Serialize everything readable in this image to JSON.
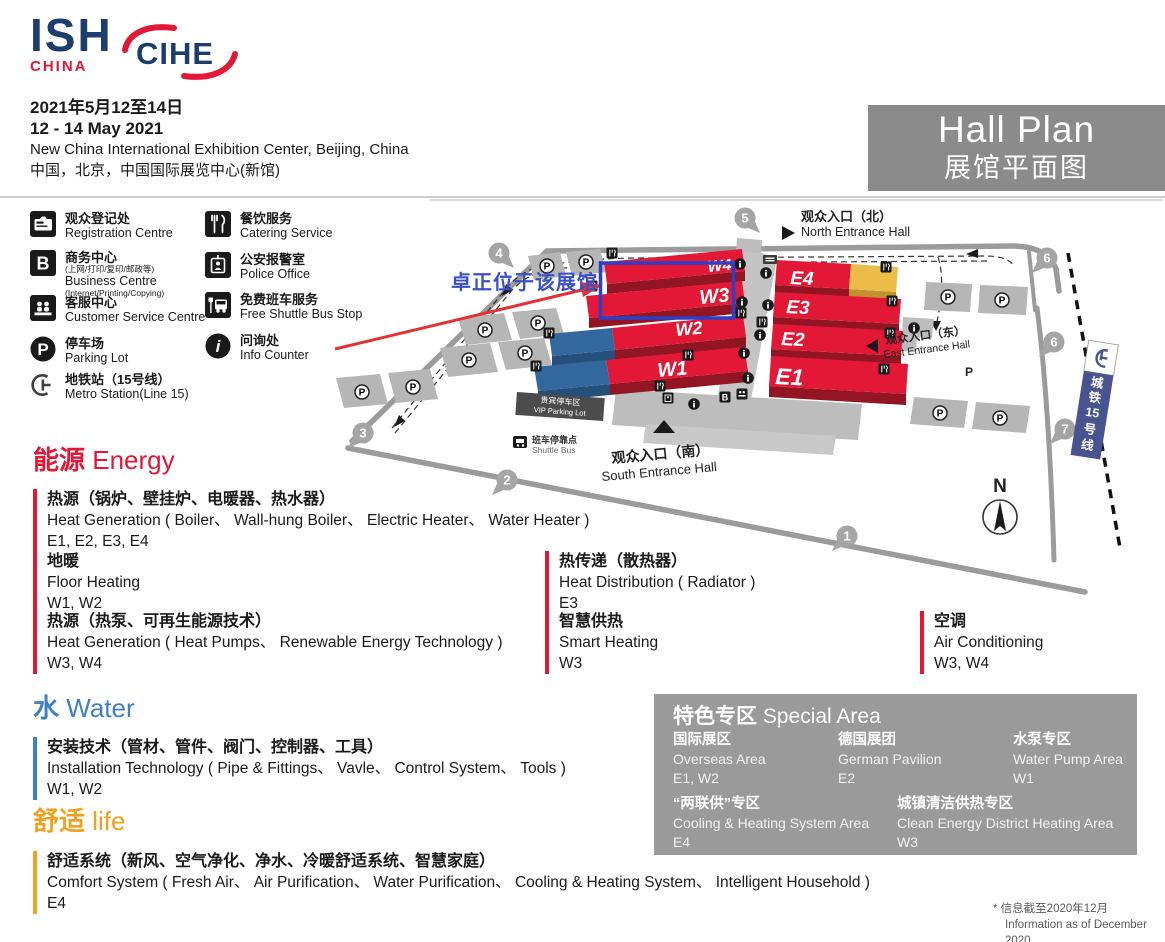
{
  "header": {
    "ish": "ISH",
    "ish_sub": "CHINA",
    "cihe": "CIHE",
    "date_cn": "2021年5月12至14日",
    "date_en": "12 - 14 May 2021",
    "venue_en": "New China International Exhibition Center, Beijing, China",
    "venue_cn": "中国，北京，中国国际展览中心(新馆)",
    "title_en": "Hall Plan",
    "title_cn": "展馆平面图"
  },
  "legend": {
    "items": [
      {
        "icon": "registration-icon",
        "cn": "观众登记处",
        "en": "Registration Centre"
      },
      {
        "icon": "business-icon",
        "glyph": "B",
        "cn": "商务中心",
        "cn_sub": "(上网/打印/复印/邮政等)",
        "en": "Business Centre",
        "en_sub": "(Internet/Printing/Copying)"
      },
      {
        "icon": "customer-service-icon",
        "cn": "客服中心",
        "en": "Customer Service Centre"
      },
      {
        "icon": "parking-icon",
        "glyph": "P",
        "cn": "停车场",
        "en": "Parking Lot"
      },
      {
        "icon": "metro-icon",
        "cn": "地铁站（15号线）",
        "en": "Metro Station(Line 15)"
      },
      {
        "icon": "catering-icon",
        "cn": "餐饮服务",
        "en": "Catering Service"
      },
      {
        "icon": "police-icon",
        "cn": "公安报警室",
        "en": "Police Office"
      },
      {
        "icon": "shuttle-bus-icon",
        "cn": "免费班车服务",
        "en": "Free Shuttle Bus Stop"
      },
      {
        "icon": "info-icon",
        "glyph": "i",
        "cn": "问询处",
        "en": "Info Counter"
      }
    ]
  },
  "map": {
    "halls": {
      "w1": "W1",
      "w2": "W2",
      "w3": "W3",
      "w4": "W4",
      "e1": "E1",
      "e2": "E2",
      "e3": "E3",
      "e4": "E4"
    },
    "entrances": {
      "north_cn": "观众入口（北）",
      "north_en": "North Entrance Hall",
      "south_cn": "观众入口（南）",
      "south_en": "South Entrance Hall",
      "east_cn": "观众入口（东）",
      "east_en": "East Entrance Hall"
    },
    "gates": [
      "1",
      "2",
      "3",
      "4",
      "5",
      "6",
      "6",
      "7"
    ],
    "vip_cn": "贵宾停车区",
    "vip_en": "VIP Parking Lot",
    "shuttle_cn": "班车停靠点",
    "shuttle_en": "Shuttle Bus",
    "metro_chars": [
      "城",
      "铁",
      "15",
      "号",
      "线"
    ],
    "compass_n": "N",
    "p": "P",
    "b": "B",
    "annotation": "卓正位于该展馆"
  },
  "sections": {
    "energy": {
      "title_cn": "能源",
      "title_en": "Energy",
      "color": "#e31837",
      "items": [
        {
          "cn": "热源（锅炉、壁挂炉、电暖器、热水器）",
          "en": "Heat Generation ( Boiler、 Wall-hung Boiler、 Electric Heater、 Water Heater )",
          "halls": "E1, E2, E3, E4"
        },
        {
          "cn": "地暖",
          "en": "Floor Heating",
          "halls": "W1, W2"
        },
        {
          "cn": "热传递（散热器）",
          "en": "Heat Distribution ( Radiator )",
          "halls": "E3"
        },
        {
          "cn": "热源（热泵、可再生能源技术）",
          "en": "Heat Generation ( Heat Pumps、 Renewable Energy Technology )",
          "halls": "W3, W4"
        },
        {
          "cn": "智慧供热",
          "en": "Smart Heating",
          "halls": "W3"
        },
        {
          "cn": "空调",
          "en": "Air Conditioning",
          "halls": "W3, W4"
        }
      ]
    },
    "water": {
      "title_cn": "水",
      "title_en": "Water",
      "color": "#4080c2",
      "items": [
        {
          "cn": "安装技术（管材、管件、阀门、控制器、工具）",
          "en": "Installation Technology ( Pipe & Fittings、 Vavle、 Control System、 Tools )",
          "halls": "W1, W2"
        }
      ]
    },
    "life": {
      "title_cn": "舒适",
      "title_en": "life",
      "color": "#f2a11c",
      "items": [
        {
          "cn": "舒适系统（新风、空气净化、净水、冷暖舒适系统、智慧家庭）",
          "en": "Comfort System ( Fresh Air、 Air Purification、 Water Purification、 Cooling & Heating System、 Intelligent Household )",
          "halls": "E4"
        }
      ]
    }
  },
  "special": {
    "title_cn": "特色专区",
    "title_en": "Special Area",
    "items": [
      {
        "cn": "国际展区",
        "en": "Overseas Area",
        "halls": "E1, W2"
      },
      {
        "cn": "德国展团",
        "en": "German Pavilion",
        "halls": "E2"
      },
      {
        "cn": "水泵专区",
        "en": "Water Pump Area",
        "halls": "W1"
      },
      {
        "cn": "“两联供”专区",
        "en": "Cooling & Heating System Area",
        "halls": "E4"
      },
      {
        "cn": "城镇清洁供热专区",
        "en": "Clean Energy District Heating Area",
        "halls": "W3"
      }
    ]
  },
  "footnote": {
    "cn": "* 信息截至2020年12月",
    "en": "Information as of December 2020"
  },
  "colors": {
    "brand_red": "#e31837",
    "brand_navy": "#1d3d6e",
    "hall_red": "#e31837",
    "hall_blue": "#33689e",
    "hall_yellow": "#edbd4a",
    "water_blue": "#4080c2",
    "life_orange": "#f2a11c",
    "annotation_blue": "#3a50c9",
    "title_gray": "#8b8b8b"
  }
}
